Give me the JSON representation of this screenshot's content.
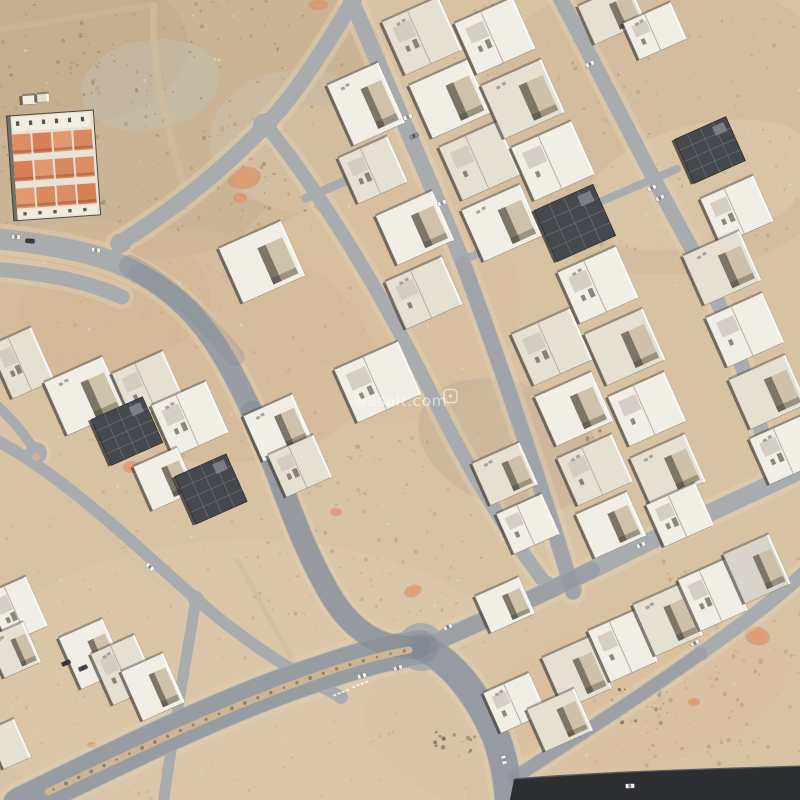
{
  "watermark": {
    "text": "wasalt.com"
  },
  "palette": {
    "sand": "#d8c2a4",
    "road": "#a9acaf",
    "road_wash": "#7e848e",
    "shoulder": "#e0cdb0",
    "asphalt": "#2d2e31",
    "asphalt_edge": "#595b60",
    "median": "#cdb493",
    "median_dot": "#6b7058",
    "villa_colors": [
      "#f1eee6",
      "#e6e0d1",
      "#d8d4c9"
    ],
    "construction": "#45484d",
    "construction_line": "#686c72",
    "orange_outer": "#d58a5f",
    "orange_inner": "#e59b6e",
    "compound_roof_colors": [
      "#dd8d64",
      "#d97f55",
      "#e2996f",
      "#d88a5f"
    ]
  },
  "scene": {
    "blobs": [
      [
        150,
        100,
        240,
        160,
        "#c7af90",
        0.75,
        -8
      ],
      [
        38,
        45,
        150,
        85,
        "#c0a888",
        0.5,
        0
      ],
      [
        150,
        85,
        70,
        45,
        "#c4c0b6",
        0.45,
        -10
      ],
      [
        300,
        140,
        90,
        70,
        "#ccc6b8",
        0.35,
        0
      ],
      [
        665,
        125,
        195,
        150,
        "#d3bc9d",
        0.8,
        0
      ],
      [
        700,
        185,
        120,
        60,
        "#dcc8ab",
        0.6,
        -15
      ],
      [
        195,
        345,
        180,
        115,
        "#d4b897",
        0.55,
        10
      ],
      [
        90,
        295,
        120,
        75,
        "#d1b593",
        0.5,
        0
      ],
      [
        370,
        300,
        150,
        125,
        "#d6bb9c",
        0.5,
        0
      ],
      [
        250,
        690,
        280,
        150,
        "#dcc6a9",
        0.7,
        0
      ],
      [
        610,
        715,
        245,
        115,
        "#d9c2a4",
        0.65,
        0
      ],
      [
        640,
        690,
        150,
        75,
        "#d7bd9d",
        0.5,
        -10
      ],
      [
        510,
        445,
        95,
        62,
        "#c2ae95",
        0.5,
        20
      ],
      [
        320,
        160,
        90,
        55,
        "#d9c0a1",
        0.5,
        0
      ]
    ],
    "mottle": [
      {
        "box": [
          0,
          0,
          320,
          230
        ],
        "n": 240,
        "r": [
          0.6,
          2.1
        ],
        "colors": [
          "#a78e6e",
          "#b79b7a",
          "#927c60"
        ],
        "op": 0.5
      },
      {
        "box": [
          320,
          0,
          180,
          120
        ],
        "n": 60,
        "r": [
          0.5,
          1.8
        ],
        "colors": [
          "#b79b7a",
          "#a78e6e"
        ],
        "op": 0.4
      },
      {
        "box": [
          545,
          15,
          255,
          235
        ],
        "n": 190,
        "r": [
          0.5,
          1.9
        ],
        "colors": [
          "#bca27b",
          "#cab28e",
          "#a58d69"
        ],
        "op": 0.42
      },
      {
        "box": [
          55,
          255,
          330,
          255
        ],
        "n": 150,
        "r": [
          0.5,
          2.0
        ],
        "colors": [
          "#b49a78",
          "#c3ab88"
        ],
        "op": 0.4
      },
      {
        "box": [
          230,
          430,
          260,
          190
        ],
        "n": 110,
        "r": [
          0.5,
          2.0
        ],
        "colors": [
          "#b09677",
          "#a18a6c"
        ],
        "op": 0.38
      },
      {
        "box": [
          140,
          530,
          520,
          270
        ],
        "n": 150,
        "r": [
          0.5,
          1.9
        ],
        "colors": [
          "#c2a988",
          "#b69d7c"
        ],
        "op": 0.35
      },
      {
        "box": [
          620,
          545,
          180,
          230
        ],
        "n": 130,
        "r": [
          0.6,
          2.2
        ],
        "colors": [
          "#ab9171",
          "#bfa584"
        ],
        "op": 0.45
      },
      {
        "box": [
          0,
          500,
          150,
          300
        ],
        "n": 80,
        "r": [
          0.5,
          1.8
        ],
        "colors": [
          "#b89e7d",
          "#c7ae8c"
        ],
        "op": 0.35
      },
      {
        "box": [
          0,
          0,
          800,
          800
        ],
        "n": 120,
        "r": [
          0.6,
          1.6
        ],
        "colors": [
          "#eedcbd",
          "#f2e3c6"
        ],
        "op": 0.5
      }
    ],
    "rubble": [
      {
        "c": [
          640,
          706
        ],
        "n": 24,
        "s": 30
      },
      {
        "c": [
          698,
          627
        ],
        "n": 16,
        "s": 22
      },
      {
        "c": [
          455,
          742
        ],
        "n": 14,
        "s": 20
      },
      {
        "c": [
          515,
          468
        ],
        "n": 16,
        "s": 22
      },
      {
        "c": [
          585,
          435
        ],
        "n": 10,
        "s": 16
      }
    ],
    "rubble_colors": [
      "#857c6b",
      "#9a9180",
      "#6f675a"
    ],
    "orange_patches": [
      [
        244,
        178,
        17,
        11,
        -10
      ],
      [
        132,
        467,
        9,
        6,
        0
      ],
      [
        757,
        636,
        13,
        9,
        15
      ],
      [
        694,
        702,
        6,
        4,
        0
      ],
      [
        92,
        745,
        5,
        3,
        0
      ],
      [
        413,
        591,
        9,
        6,
        -20
      ],
      [
        318,
        5,
        10,
        5,
        0
      ],
      [
        336,
        512,
        6,
        4,
        0
      ],
      [
        240,
        198,
        7,
        5,
        0
      ]
    ],
    "tracks": [
      {
        "d": "M154,6 C150,62 166,124 183,184",
        "w": 7,
        "c": "#cdbb9e",
        "op": 0.8
      },
      {
        "d": "M-4,30 C50,22 100,13 152,5",
        "w": 6,
        "c": "#cbb89a",
        "op": 0.7
      },
      {
        "d": "M237,560 C260,600 280,640 300,672",
        "w": 5,
        "c": "#cdbb9e",
        "op": 0.6
      },
      {
        "d": "M60,480 C90,520 130,560 170,590",
        "w": 4,
        "c": "#d2c0a2",
        "op": 0.5
      }
    ],
    "roads": [
      {
        "d": "M-8,238 C55,245 102,253 138,273 C195,303 222,348 252,412 C278,468 295,535 330,594 C355,637 388,650 419,647",
        "w": 21
      },
      {
        "d": "M-8,269 C45,273 86,281 122,297",
        "w": 15
      },
      {
        "d": "M358,-8 C330,40 296,95 265,126 C230,162 180,206 118,244",
        "w": 16
      },
      {
        "d": "M265,124 C320,192 380,290 431,393 C466,466 506,531 547,586",
        "w": 14
      },
      {
        "d": "M348,-8 C400,115 441,206 463,263 C500,362 546,500 573,592",
        "w": 16
      },
      {
        "d": "M557,-8 C600,74 651,176 694,253 C721,301 751,381 771,470",
        "w": 15
      },
      {
        "d": "M419,649 C490,618 560,586 626,553 C691,521 746,496 805,468",
        "w": 18
      },
      {
        "d": "M514,778 C570,741 641,696 701,653 C741,625 773,601 805,572",
        "w": 14
      },
      {
        "d": "M20,805 C110,761 231,701 321,673 C361,659 396,651 421,647",
        "w": 36
      },
      {
        "d": "M421,647 C453,661 479,697 496,737 C504,759 508,781 509,805",
        "w": 29
      },
      {
        "d": "M-8,438 C60,473 131,541 196,599 C236,634 286,669 341,697",
        "w": 12,
        "sh": 0
      },
      {
        "d": "M196,599 C186,661 173,731 163,805",
        "w": 11,
        "sh": 0
      },
      {
        "d": "M-8,401 C12,419 27,437 36,453",
        "w": 10,
        "sh": 0
      },
      {
        "d": "M306,198 L357,176",
        "w": 9,
        "sh": 0
      },
      {
        "d": "M461,261 L677,169",
        "w": 8,
        "sh": 0
      }
    ],
    "pads": [
      [
        265,
        125,
        12
      ],
      [
        121,
        243,
        10
      ],
      [
        196,
        599,
        8
      ],
      [
        547,
        585,
        9
      ],
      [
        573,
        590,
        9
      ],
      [
        771,
        468,
        8
      ],
      [
        701,
        653,
        8
      ],
      [
        341,
        697,
        7
      ],
      [
        36,
        453,
        11
      ],
      [
        421,
        647,
        24
      ]
    ],
    "washes": [
      {
        "d": "M130,266 C195,300 222,348 252,412",
        "w": 22,
        "o": 0.35
      },
      {
        "d": "M252,412 C278,468 295,535 330,594 C355,637 388,650 419,647",
        "w": 23,
        "o": 0.45
      },
      {
        "d": "M20,805 C110,761 231,701 321,673 C361,659 396,651 421,647",
        "w": 34,
        "o": 0.4
      },
      {
        "d": "M421,647 C453,661 479,697 496,737 C504,759 508,781 509,805",
        "w": 27,
        "o": 0.42
      },
      {
        "d": "M419,649 C470,628 530,600 592,570",
        "w": 16,
        "o": 0.3
      },
      {
        "d": "M514,778 C570,741 641,696 701,653",
        "w": 12,
        "o": 0.28
      },
      {
        "d": "M463,263 C500,362 546,500 573,592",
        "w": 14,
        "o": 0.22
      },
      {
        "d": "M138,273 C180,295 205,320 235,357",
        "w": 19,
        "o": 0.28
      }
    ],
    "median": {
      "d": "M48,792 C130,753 235,703 330,671 C360,661 390,653 409,650",
      "w": 7
    },
    "markings": [
      {
        "x": 333,
        "y": 695,
        "rot": -22
      },
      {
        "x": 352,
        "y": 687,
        "rot": -22
      }
    ],
    "asphalt": {
      "d": "M509,805 L514,779 C600,772 700,769 805,766 L805,805 Z",
      "edge": "M514,779 C600,772 700,769 805,766"
    },
    "compound": {
      "x": 10,
      "y": 113,
      "w": 87,
      "h": 105,
      "rot": -4,
      "cx": 53,
      "cy": 165,
      "rows_y": [
        131,
        158,
        185
      ],
      "row_h": 22,
      "cells": 4
    },
    "villas": [
      [
        366,
        104,
        56,
        66,
        0
      ],
      [
        373,
        170,
        54,
        50,
        1
      ],
      [
        415,
        228,
        62,
        54,
        0
      ],
      [
        424,
        293,
        62,
        52,
        1
      ],
      [
        262,
        262,
        68,
        60,
        0
      ],
      [
        378,
        382,
        70,
        58,
        0
      ],
      [
        505,
        474,
        52,
        46,
        1
      ],
      [
        528,
        524,
        50,
        44,
        0
      ],
      [
        505,
        605,
        48,
        40,
        0
      ],
      [
        422,
        36,
        62,
        58,
        1
      ],
      [
        450,
        99,
        64,
        58,
        0
      ],
      [
        480,
        161,
        64,
        58,
        1
      ],
      [
        502,
        223,
        64,
        56,
        0
      ],
      [
        552,
        347,
        64,
        56,
        1
      ],
      [
        574,
        409,
        62,
        54,
        0
      ],
      [
        595,
        470,
        60,
        52,
        1
      ],
      [
        611,
        525,
        56,
        48,
        0
      ],
      [
        495,
        36,
        64,
        56,
        0
      ],
      [
        523,
        99,
        66,
        58,
        1
      ],
      [
        553,
        161,
        66,
        58,
        0
      ],
      [
        575,
        223,
        64,
        56,
        3
      ],
      [
        598,
        285,
        64,
        56,
        0
      ],
      [
        625,
        347,
        64,
        56,
        1
      ],
      [
        647,
        409,
        62,
        54,
        0
      ],
      [
        668,
        470,
        60,
        52,
        1
      ],
      [
        680,
        515,
        54,
        46,
        0
      ],
      [
        612,
        14,
        56,
        42,
        1
      ],
      [
        655,
        31,
        52,
        40,
        0
      ],
      [
        710,
        150,
        56,
        48,
        3
      ],
      [
        737,
        210,
        58,
        50,
        0
      ],
      [
        722,
        268,
        62,
        54,
        1
      ],
      [
        745,
        330,
        62,
        54,
        0
      ],
      [
        768,
        392,
        62,
        54,
        1
      ],
      [
        786,
        450,
        58,
        50,
        0
      ],
      [
        577,
        673,
        52,
        56,
        1
      ],
      [
        623,
        646,
        52,
        56,
        0
      ],
      [
        668,
        620,
        52,
        56,
        1
      ],
      [
        713,
        595,
        52,
        56,
        0
      ],
      [
        757,
        569,
        50,
        54,
        2
      ],
      [
        515,
        703,
        50,
        44,
        0
      ],
      [
        560,
        720,
        52,
        46,
        1
      ],
      [
        22,
        363,
        46,
        58,
        1
      ],
      [
        85,
        396,
        64,
        58,
        0
      ],
      [
        148,
        386,
        56,
        52,
        1
      ],
      [
        127,
        431,
        56,
        50,
        3
      ],
      [
        190,
        419,
        60,
        56,
        0
      ],
      [
        165,
        479,
        48,
        48,
        0
      ],
      [
        211,
        489,
        56,
        52,
        3
      ],
      [
        278,
        428,
        54,
        50,
        0
      ],
      [
        300,
        466,
        50,
        46,
        1
      ],
      [
        92,
        654,
        48,
        56,
        0
      ],
      [
        124,
        670,
        48,
        56,
        1
      ],
      [
        153,
        687,
        46,
        54,
        0
      ],
      [
        17,
        610,
        44,
        54,
        0
      ],
      [
        14,
        650,
        40,
        44,
        1
      ],
      [
        9,
        744,
        30,
        42,
        1
      ],
      [
        29,
        100,
        13,
        9,
        0,
        -4
      ],
      [
        43,
        98,
        12,
        8,
        1,
        -4
      ]
    ],
    "cars": [
      [
        16,
        237,
        4,
        "#ececec"
      ],
      [
        30,
        241,
        4,
        "#3d3d41"
      ],
      [
        96,
        250,
        8,
        "#f2f2f2"
      ],
      [
        408,
        117,
        -22,
        "#f6f6f6"
      ],
      [
        442,
        203,
        -22,
        "#fafafa"
      ],
      [
        414,
        136,
        -22,
        "#8f9094"
      ],
      [
        590,
        64,
        -27,
        "#fafafa"
      ],
      [
        652,
        188,
        -27,
        "#f4f4f4"
      ],
      [
        660,
        198,
        -27,
        "#e9e9e9"
      ],
      [
        641,
        545,
        -25,
        "#fafafa"
      ],
      [
        448,
        627,
        -25,
        "#f0f0f0"
      ],
      [
        362,
        676,
        -18,
        "#fafafa"
      ],
      [
        398,
        668,
        -18,
        "#ededed"
      ],
      [
        66,
        663,
        -24,
        "#3a3a3e"
      ],
      [
        83,
        668,
        -24,
        "#4a4a4e"
      ],
      [
        504,
        760,
        78,
        "#f6f6f6"
      ],
      [
        695,
        643,
        -30,
        "#f0f0f0"
      ],
      [
        630,
        786,
        -2,
        "#f4f4f4"
      ],
      [
        150,
        567,
        42,
        "#fafafa"
      ]
    ]
  }
}
